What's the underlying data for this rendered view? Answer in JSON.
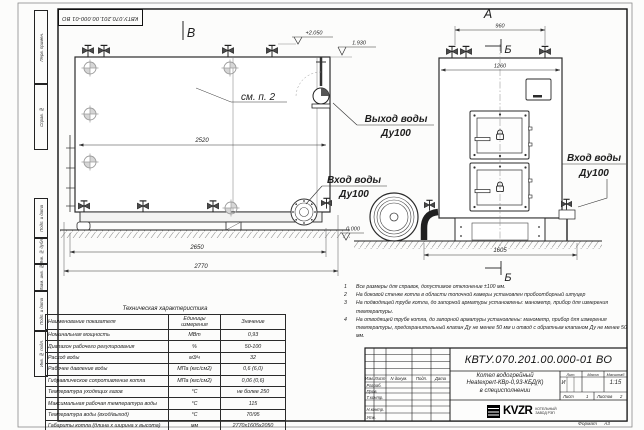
{
  "corner_stamp": {
    "designation": "КВТУ.070.201.00.000-01 ВО"
  },
  "margin": {
    "items": [
      {
        "label": "Перв. примен."
      },
      {
        "label": "Справ. №"
      },
      {
        "label": "Подп. и дата"
      },
      {
        "label": "Инв. № дубл."
      },
      {
        "label": "Взам. инв. №"
      },
      {
        "label": "Подп. и дата"
      },
      {
        "label": "Инв. № подл."
      }
    ]
  },
  "views": {
    "label_a": "А",
    "label_b_view": "В",
    "label_b_section_top": "Б",
    "label_b_section_bottom": "Б",
    "see_note": "см. п. 2",
    "elev_top": "+2.050",
    "elev_mid": "1.930",
    "elev_zero": "0.000",
    "dim_2520": "2520",
    "dim_2650": "2650",
    "dim_2770": "2770",
    "dim_960": "960",
    "dim_1260": "1260",
    "dim_1605": "1605",
    "water_out_1": "Выход воды",
    "water_out_2": "Ду100",
    "water_in_left_1": "Вход воды",
    "water_in_left_2": "Ду100",
    "water_in_right_1": "Вход воды",
    "water_in_right_2": "Ду100"
  },
  "notes": {
    "items": [
      {
        "n": "1",
        "text": "Все размеры для справок, допустимое отклонение ±100 мм."
      },
      {
        "n": "2",
        "text": "На боковой стенке котла в области топочной камеры установлен пробоотборный штуцер"
      },
      {
        "n": "3",
        "text": "На подводящей трубе котла, до запорной арматуры установлены: манометр, прибор для измерения температуры."
      },
      {
        "n": "4",
        "text": "На отводящей трубе котла, до запорной арматуры установлены: манометр, прибор для измерения температуры, предохранительный клапан Ду не менее 50 мм и отвод с обратным клапаном Ду не менее 50 мм."
      }
    ]
  },
  "spec_table": {
    "title": "Техническая характеристика",
    "headers": [
      "Наименование показателя",
      "Единицы измерения",
      "Значение"
    ],
    "rows": [
      [
        "Номинальная мощность",
        "МВт",
        "0,93"
      ],
      [
        "Диапазон рабочего регулирования",
        "%",
        "50-100"
      ],
      [
        "Расход воды",
        "м3/ч",
        "32"
      ],
      [
        "Рабочее давление воды",
        "МПа (кгс/см2)",
        "0,6 (6,0)"
      ],
      [
        "Гидравлическое сопротивление котла",
        "МПа (кгс/см2)",
        "0,06 (0,6)"
      ],
      [
        "Температура уходящих газов",
        "°С",
        "не более 250"
      ],
      [
        "Максимальная рабочая температура воды",
        "°С",
        "115"
      ],
      [
        "Температура воды (вход/выход)",
        "°С",
        "70/95"
      ],
      [
        "Габариты котла (длина х ширина х высота)",
        "мм",
        "2770х1605х2050"
      ]
    ]
  },
  "title_block": {
    "designation": "КВТУ.070.201.00.000-01 ВО",
    "name_line1": "Котел водогрейный",
    "name_line2": "Heatexpert-КВр-0,93-КБД(К)",
    "name_line3": "в специсполнении",
    "col_izm": "Изм.",
    "col_list": "Лист",
    "col_docum": "N докум.",
    "col_podp": "Подп.",
    "col_data": "Дата",
    "row_razrab": "Разраб.",
    "row_prov": "Пров.",
    "row_tkontr": "Т.контр.",
    "row_nkontr": "Н.контр.",
    "row_utv": "Утв.",
    "lit_label": "Лит.",
    "mass_label": "Масса",
    "scale_label": "Масштаб",
    "lit_value": "И",
    "scale_value": "1:15",
    "sheet_label": "Лист",
    "sheet_value": "1",
    "sheets_label": "Листов",
    "sheets_value": "2",
    "logo": "KVZR",
    "org_line1": "КОТЕЛЬНЫЙ",
    "org_line2": "ЗАВОД РЭП",
    "format_label": "Формат",
    "format_value": "А3"
  }
}
